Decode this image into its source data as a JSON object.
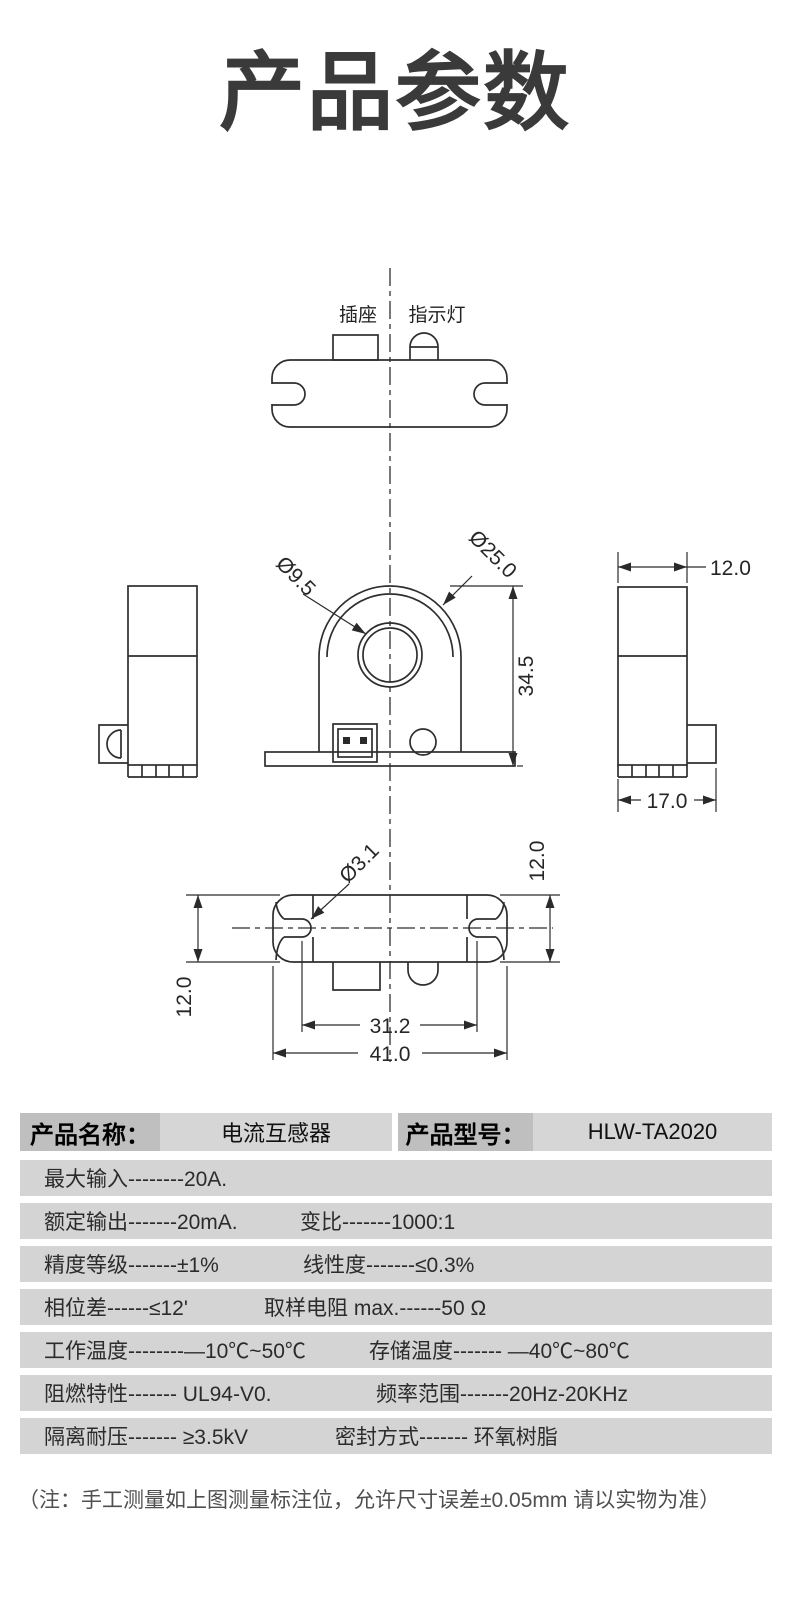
{
  "page": {
    "title": "产品参数"
  },
  "colors": {
    "title": "#3a3a3a",
    "line": "#2e2e2e",
    "row_background": "#d4d4d4",
    "label_background": "#bfbfbf",
    "value_background": "#d6d6d6"
  },
  "drawing": {
    "top_view": {
      "socket_label": "插座",
      "indicator_label": "指示灯"
    },
    "front_view": {
      "inner_hole_dia": "Ø9.5",
      "outer_dia": "Ø25.0",
      "body_height": "34.5"
    },
    "right_view": {
      "top_width": "12.0",
      "base_width": "17.0"
    },
    "bottom_view": {
      "slot_dia": "Ø3.1",
      "depth_left": "12.0",
      "depth_right": "12.0",
      "slot_spacing": "31.2",
      "overall_width": "41.0"
    }
  },
  "table": {
    "header": {
      "name_label": "产品名称：",
      "name_value": "电流互感器",
      "model_label": "产品型号：",
      "model_value": "HLW-TA2020"
    },
    "rows": [
      {
        "left": "最大输入--------20A.",
        "right": ""
      },
      {
        "left": "额定输出-------20mA.",
        "right": "变比-------1000:1"
      },
      {
        "left": "精度等级-------±1%",
        "right": "线性度-------≤0.3%"
      },
      {
        "left": "相位差------≤12'",
        "right": "取样电阻 max.------50 Ω"
      },
      {
        "left": "工作温度--------—10℃~50℃",
        "right": "存储温度------- —40℃~80℃"
      },
      {
        "left": "阻燃特性------- UL94-V0.",
        "right": "频率范围-------20Hz-20KHz"
      },
      {
        "left": "隔离耐压------- ≥3.5kV",
        "right": "密封方式------- 环氧树脂"
      }
    ],
    "note": "（注：手工测量如上图测量标注位，允许尺寸误差±0.05mm 请以实物为准）"
  }
}
